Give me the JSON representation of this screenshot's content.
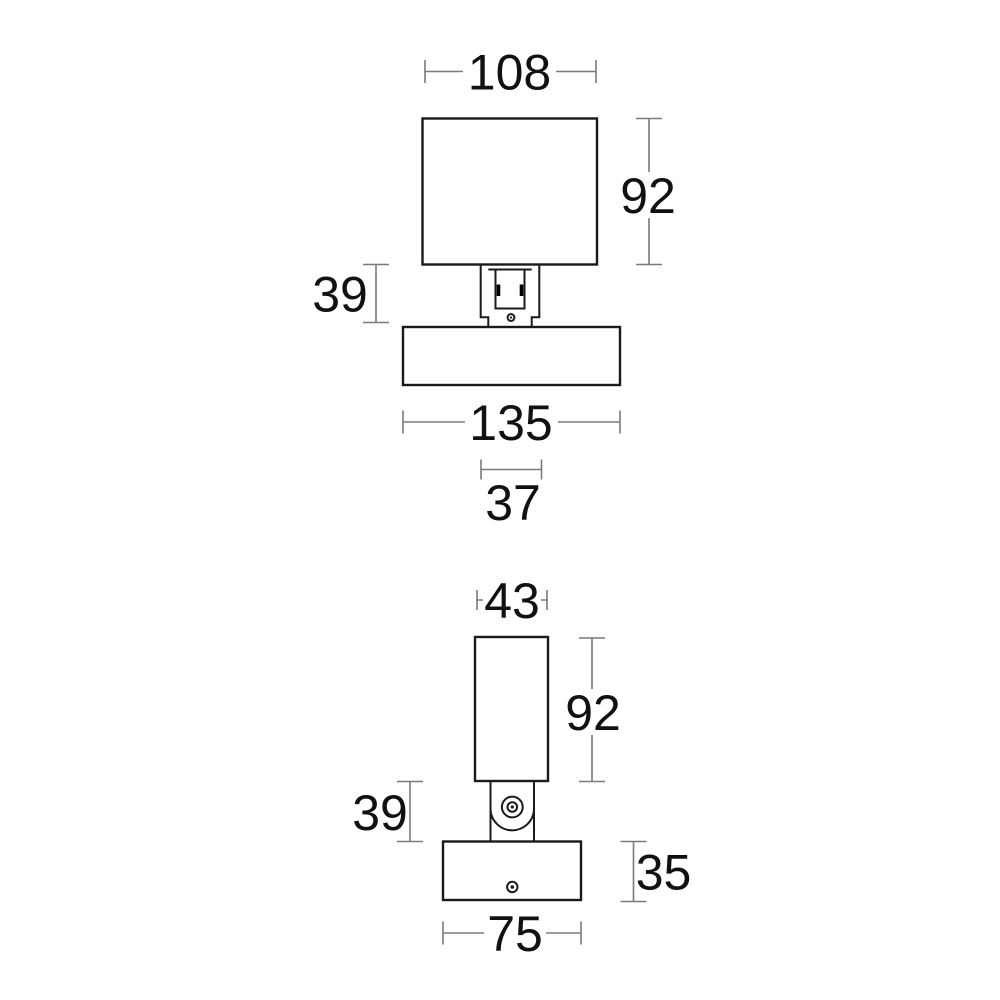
{
  "drawing": {
    "title": "wall-light technical dimension drawing, two orthographic views",
    "units": "mm",
    "colors": {
      "background": "#ffffff",
      "outline": "#1a1a1a",
      "dimension_line": "#7a7a7a",
      "dimension_text": "#111111"
    },
    "front_view": {
      "name": "front view (lamp shade, bracket, wall plate)",
      "dims": {
        "shade_width": "108",
        "shade_height": "92",
        "bracket_height": "39",
        "wallplate_width": "135",
        "bracket_width": "37"
      }
    },
    "side_view": {
      "name": "side view (body tube, hinge, wall plate)",
      "dims": {
        "body_width": "43",
        "body_height": "92",
        "hinge_height": "39",
        "wallplate_height": "35",
        "wallplate_width": "75"
      }
    }
  }
}
